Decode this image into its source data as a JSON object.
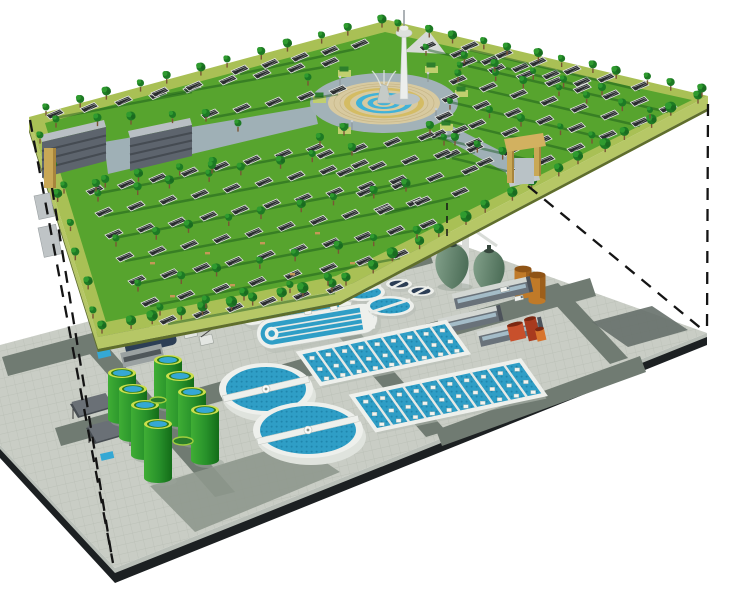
{
  "canvas": {
    "w": 740,
    "h": 589,
    "background": "#ffffff"
  },
  "palette": {
    "lawn": "#57a42e",
    "lawn_shadow": "#14541a",
    "border_path": "#a9c055",
    "platform_side": "#b6c766",
    "platform_side_dark": "#5f6e2c",
    "tree_dark": "#1d7a24",
    "tree_light": "#2f9b2f",
    "tree_deep": "#1a6b20",
    "trunk": "#7a5535",
    "panel": "#2a2d2f",
    "panel_frame": "#e4e7e3",
    "panel_grid": "#dcdfdb",
    "building_face": "#5d646d",
    "building_roof": "#b9bfc4",
    "building_band": "#454b52",
    "building_path": "#9fb0b6",
    "plaza_road": "#a2b2b8",
    "plaza_tan": "#d8caa0",
    "plaza_joint": "#c6b586",
    "plaza_yellow": "#d4bc64",
    "plaza_blue": "#41b2d8",
    "fountain_stone": "#c5cbc7",
    "fountain_spray": "#dfe5e1",
    "hedge_base": "#c0cf6e",
    "hedge_top": "#2e7f2c",
    "gate_tan": "#c9a856",
    "gate_shade": "#a8853c",
    "gate_lintel": "#d2b160",
    "tower_white": "#eceeec",
    "tower_shade": "#c7ccc9",
    "concrete": "#c9cdc5",
    "tile_line": "#b8bdb4",
    "road": "#707b72",
    "pad_dark": "#8e988d",
    "pad_deep": "#66706a",
    "edge_light": "#b9bfb8",
    "edge_dark": "#1c2022",
    "white_struct": "#eef0ec",
    "struct_shadow": "#b7bdb5",
    "water": "#2f9ec6",
    "water_dot": "#1f86ad",
    "tank_green_light": "#3fae35",
    "tank_green_dark": "#136c18",
    "tank_rim": "#cbdf4b",
    "tank_top_blue": "#35a8d4",
    "egg_light": "#83a18b",
    "egg_dark": "#4e6f59",
    "egg_cap": "#35463c",
    "orange": "#c07a28",
    "orange_dark": "#8f5416",
    "shed_face": "#69727a",
    "shed_roof": "#d3d7d3",
    "shed_window": "#a4bcc8",
    "shed_end": "#4c525a",
    "red_main": "#c8502c",
    "red_dark": "#a83a1e",
    "red_orange": "#d8742c",
    "navy": "#2c3e55",
    "gray_box": "#9aa1a1",
    "pavilion": "#474d52",
    "dash": "#141414"
  },
  "upper_layer": {
    "platform_top": [
      [
        29,
        117
      ],
      [
        388,
        20
      ],
      [
        708,
        96
      ],
      [
        340,
        290
      ],
      [
        98,
        337
      ]
    ],
    "lawn": [
      [
        45,
        123
      ],
      [
        385,
        32
      ],
      [
        692,
        100
      ],
      [
        336,
        276
      ],
      [
        106,
        322
      ]
    ],
    "side_depth": 12,
    "buildings": [
      {
        "face": [
          [
            42,
            142
          ],
          [
            106,
            127
          ],
          [
            106,
            161
          ],
          [
            42,
            178
          ]
        ],
        "roof": [
          [
            42,
            142
          ],
          [
            106,
            127
          ],
          [
            104,
            120
          ],
          [
            40,
            135
          ]
        ]
      },
      {
        "face": [
          [
            130,
            138
          ],
          [
            192,
            125
          ],
          [
            192,
            156
          ],
          [
            130,
            171
          ]
        ],
        "roof": [
          [
            130,
            138
          ],
          [
            192,
            125
          ],
          [
            190,
            118
          ],
          [
            128,
            131
          ]
        ]
      }
    ],
    "paths": [
      [
        [
          104,
          142
        ],
        [
          314,
          106
        ],
        [
          318,
          124
        ],
        [
          108,
          174
        ]
      ],
      [
        [
          448,
          124
        ],
        [
          522,
          162
        ],
        [
          512,
          176
        ],
        [
          440,
          136
        ]
      ]
    ],
    "plaza": {
      "cx": 384,
      "cy": 103,
      "road": [
        74,
        30
      ],
      "disc": [
        56,
        21.5
      ],
      "rings": [
        [
          40,
          15.2,
          "plaza_yellow"
        ],
        [
          34,
          12.8,
          "plaza_tan"
        ],
        [
          28,
          10.4,
          "plaza_blue"
        ],
        [
          22,
          8.1,
          "plaza_tan"
        ],
        [
          16.5,
          6,
          "plaza_blue"
        ],
        [
          11,
          3.9,
          "plaza_tan"
        ],
        [
          6.5,
          2.3,
          "plaza_blue"
        ]
      ],
      "joints": [
        50,
        44
      ]
    },
    "tower": {
      "cx": 404,
      "base_y": 99,
      "deck_y": 33,
      "top_y": 10,
      "membrane": [
        [
          404,
          52
        ],
        [
          446,
          54
        ],
        [
          428,
          30
        ]
      ]
    },
    "gates": {
      "left": {
        "x": 44,
        "y": 148,
        "w": 12,
        "h": 40
      },
      "right": {
        "posts": [
          [
            507,
            150,
            7,
            33
          ],
          [
            534,
            143,
            7,
            33
          ]
        ],
        "lintel": [
          [
            504,
            139
          ],
          [
            543,
            133
          ],
          [
            546,
            146
          ],
          [
            507,
            152
          ]
        ],
        "opening": [
          515,
          158,
          19,
          26
        ],
        "ramp": [
          [
            506,
            172
          ],
          [
            536,
            165
          ],
          [
            540,
            180
          ],
          [
            510,
            187
          ]
        ]
      }
    },
    "step_blocks": [
      [
        34,
        196,
        16,
        24
      ],
      [
        38,
        228,
        18,
        30
      ]
    ],
    "solar_rows": [
      [
        95,
        188,
        315,
        146,
        8
      ],
      [
        104,
        210,
        360,
        162,
        9
      ],
      [
        114,
        232,
        398,
        178,
        10
      ],
      [
        125,
        255,
        415,
        200,
        10
      ],
      [
        137,
        278,
        428,
        222,
        10
      ],
      [
        150,
        300,
        400,
        252,
        8
      ],
      [
        168,
        318,
        335,
        287,
        6
      ],
      [
        55,
        112,
        192,
        86,
        5
      ],
      [
        160,
        90,
        330,
        60,
        6
      ],
      [
        210,
        112,
        338,
        88,
        5
      ],
      [
        240,
        68,
        360,
        42,
        5
      ],
      [
        428,
        44,
        582,
        80,
        6
      ],
      [
        470,
        44,
        640,
        84,
        6
      ],
      [
        468,
        60,
        668,
        106,
        8
      ],
      [
        458,
        78,
        640,
        120,
        7
      ],
      [
        450,
        96,
        608,
        133,
        6
      ],
      [
        444,
        114,
        576,
        146,
        5
      ],
      [
        438,
        132,
        546,
        158,
        4
      ],
      [
        452,
        152,
        518,
        168,
        3
      ],
      [
        325,
        152,
        460,
        128,
        5
      ],
      [
        345,
        170,
        475,
        146,
        5
      ],
      [
        365,
        190,
        470,
        168,
        4
      ],
      [
        385,
        208,
        460,
        190,
        3
      ]
    ],
    "tree_lines": [
      [
        104,
        330,
        330,
        288,
        10,
        5
      ],
      [
        348,
        282,
        696,
        100,
        16,
        5
      ],
      [
        48,
        112,
        380,
        24,
        12,
        4
      ],
      [
        400,
        28,
        700,
        93,
        12,
        4
      ],
      [
        42,
        140,
        95,
        315,
        7,
        4
      ],
      [
        100,
        198,
        350,
        152,
        8,
        4
      ],
      [
        118,
        243,
        408,
        188,
        9,
        4
      ],
      [
        140,
        288,
        415,
        235,
        8,
        4
      ],
      [
        162,
        312,
        330,
        282,
        5,
        4
      ],
      [
        58,
        124,
        208,
        118,
        5,
        4
      ],
      [
        66,
        190,
        215,
        166,
        5,
        4
      ],
      [
        462,
        70,
        652,
        115,
        7,
        3.5
      ],
      [
        452,
        106,
        594,
        140,
        5,
        3.5
      ],
      [
        446,
        142,
        534,
        163,
        4,
        3.5
      ],
      [
        428,
        52,
        600,
        92,
        6,
        3.5
      ]
    ],
    "tree_singles": [
      [
        320,
        142,
        4
      ],
      [
        344,
        132,
        4
      ],
      [
        430,
        130,
        4
      ],
      [
        455,
        142,
        4
      ],
      [
        308,
        82,
        3.5
      ],
      [
        458,
        78,
        3.5
      ],
      [
        96,
        188,
        4
      ],
      [
        238,
        128,
        3.5
      ],
      [
        212,
        170,
        4
      ]
    ],
    "hedges": [
      [
        313,
        96
      ],
      [
        338,
        70
      ],
      [
        425,
        66
      ],
      [
        455,
        90
      ],
      [
        440,
        124
      ],
      [
        338,
        127
      ]
    ],
    "lamps": [
      [
        340,
        86
      ],
      [
        428,
        82
      ],
      [
        352,
        130
      ],
      [
        436,
        118
      ]
    ],
    "benches": [
      [
        150,
        262
      ],
      [
        205,
        252
      ],
      [
        260,
        242
      ],
      [
        315,
        232
      ],
      [
        170,
        295
      ],
      [
        230,
        284
      ],
      [
        290,
        273
      ],
      [
        350,
        262
      ]
    ]
  },
  "lower_layer": {
    "platform_top": [
      [
        0,
        345
      ],
      [
        425,
        232
      ],
      [
        707,
        333
      ],
      [
        115,
        568
      ],
      [
        0,
        445
      ]
    ],
    "roads": [
      [
        [
          2,
          357
        ],
        [
          427,
          244
        ],
        [
          433,
          263
        ],
        [
          8,
          376
        ]
      ],
      [
        [
          55,
          428
        ],
        [
          590,
          278
        ],
        [
          596,
          296
        ],
        [
          61,
          446
        ]
      ],
      [
        [
          88,
          352
        ],
        [
          108,
          347
        ],
        [
          235,
          492
        ],
        [
          215,
          497
        ]
      ],
      [
        [
          300,
          292
        ],
        [
          320,
          287
        ],
        [
          446,
          431
        ],
        [
          426,
          437
        ]
      ],
      [
        [
          540,
          288
        ],
        [
          558,
          283
        ],
        [
          628,
          358
        ],
        [
          610,
          364
        ]
      ],
      [
        [
          436,
          430
        ],
        [
          640,
          356
        ],
        [
          646,
          372
        ],
        [
          442,
          446
        ]
      ]
    ],
    "pads": [
      {
        "pts": [
          [
            150,
            486
          ],
          [
            295,
            442
          ],
          [
            340,
            472
          ],
          [
            195,
            532
          ]
        ],
        "color": "pad_dark"
      },
      {
        "pts": [
          [
            592,
            322
          ],
          [
            652,
            306
          ],
          [
            688,
            330
          ],
          [
            628,
            347
          ]
        ],
        "color": "pad_deep"
      }
    ],
    "blue_pads": [
      [
        97,
        352
      ],
      [
        100,
        454
      ]
    ],
    "small_tanks": [
      [
        399,
        284
      ],
      [
        421,
        291
      ]
    ],
    "eggs": {
      "frame_rects": [
        [
          462,
          230,
          7,
          58
        ],
        [
          448,
          238,
          5,
          50
        ]
      ],
      "frame_lines": [
        [
          448,
          240,
          474,
          230
        ],
        [
          474,
          230,
          497,
          246
        ]
      ],
      "bodies": [
        [
          452,
          243,
          32,
          46
        ],
        [
          489,
          249,
          30,
          44
        ]
      ],
      "mast": [
        449,
        212,
        449,
        244
      ]
    },
    "orange_tanks": [
      [
        523,
        269
      ],
      [
        537,
        275
      ]
    ],
    "sheds": [
      [
        492,
        295,
        76
      ],
      [
        470,
        322,
        60
      ],
      [
        510,
        334,
        62
      ]
    ],
    "trucks": [
      [
        500,
        288
      ],
      [
        514,
        297
      ]
    ],
    "red_unit": {
      "blocks": [
        [
          507,
          326,
          16,
          16,
          "red_main"
        ],
        [
          524,
          320,
          12,
          22,
          "red_dark"
        ],
        [
          535,
          330,
          9,
          12,
          "red_orange"
        ]
      ]
    },
    "inlet": {
      "x": 150,
      "y": 340
    },
    "cranes": [
      [
        183,
        330
      ],
      [
        199,
        337
      ]
    ],
    "pavilions": [
      {
        "roof": [
          [
            70,
            404
          ],
          [
            104,
            395
          ],
          [
            112,
            408
          ],
          [
            78,
            418
          ]
        ]
      },
      {
        "roof": [
          [
            86,
            428
          ],
          [
            124,
            418
          ],
          [
            133,
            433
          ],
          [
            95,
            444
          ]
        ]
      }
    ],
    "ditches": [
      [
        295,
        303,
        118,
        30
      ],
      [
        317,
        326,
        122,
        30
      ]
    ],
    "round_tanks": [
      [
        362,
        292,
        23,
        9
      ],
      [
        390,
        306,
        24,
        10
      ]
    ],
    "basins": [
      {
        "p": [
          299,
          353
        ],
        "L": 150,
        "W": 38,
        "channels": 9
      },
      {
        "p": [
          352,
          396
        ],
        "L": 172,
        "W": 42,
        "channels": 10
      }
    ],
    "clarifiers": [
      [
        266,
        389,
        47,
        26
      ],
      [
        308,
        430,
        55,
        28
      ]
    ],
    "green_tanks": [
      [
        168,
        360,
        44
      ],
      [
        180,
        376,
        46
      ],
      [
        192,
        392,
        48
      ],
      [
        205,
        410,
        50
      ],
      [
        122,
        373,
        46
      ],
      [
        133,
        389,
        48
      ],
      [
        145,
        405,
        50
      ],
      [
        158,
        424,
        54
      ]
    ],
    "ground_discs": [
      [
        183,
        441,
        10,
        4
      ],
      [
        158,
        400,
        8,
        3
      ]
    ]
  },
  "projection_lines": {
    "dashed": [
      [
        30,
        120,
        113,
        563
      ],
      [
        52,
        188,
        112,
        558
      ],
      [
        708,
        104,
        707,
        330
      ],
      [
        528,
        186,
        703,
        330
      ]
    ],
    "short": [
      [
        447,
        203,
        447,
        236
      ]
    ]
  }
}
